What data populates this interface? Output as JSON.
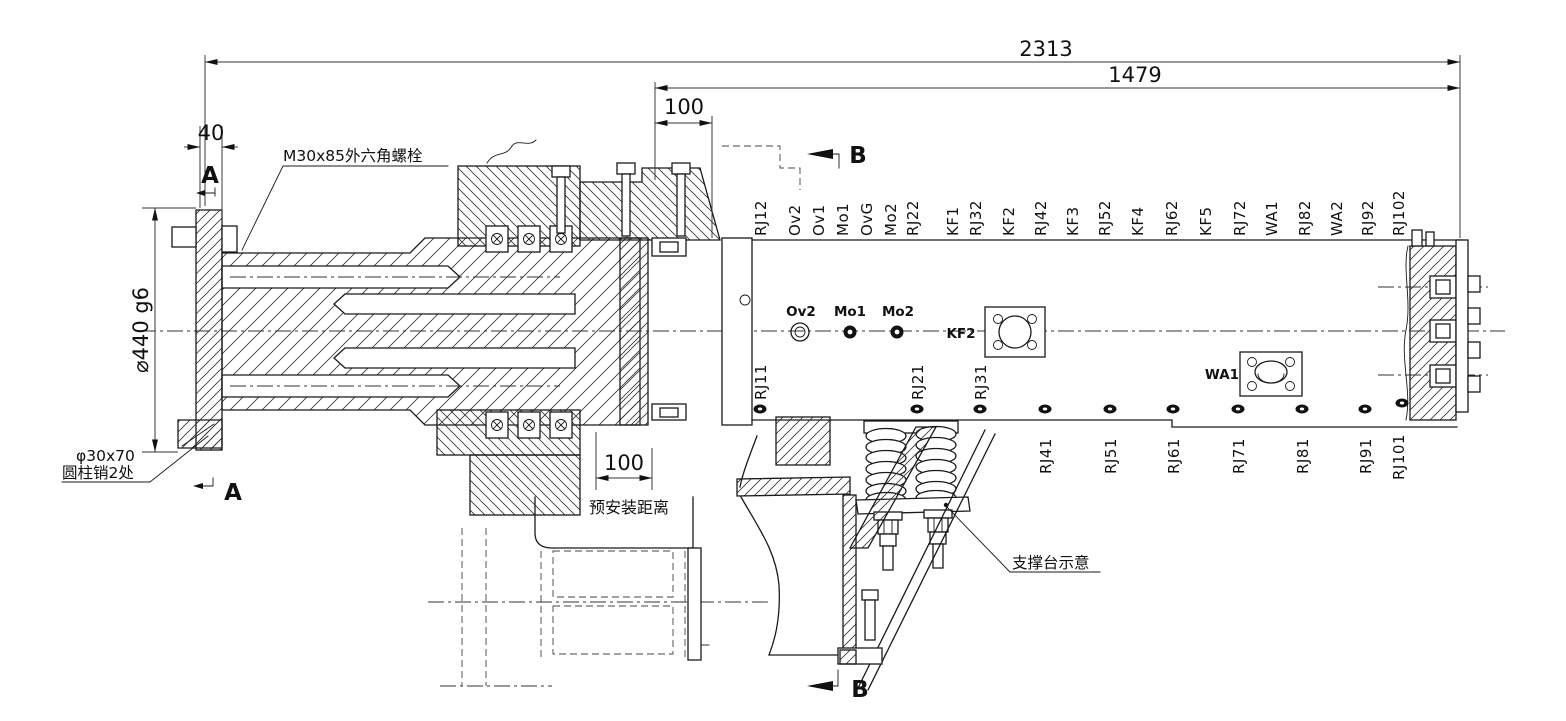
{
  "drawing": {
    "background": "#ffffff",
    "line_color": "#1a1a1a",
    "dimensions": {
      "overall_length": "2313",
      "beam_length": "1479",
      "top_offset": "100",
      "flange_thickness": "40",
      "flange_diameter": "⌀440 g6",
      "preinstall_gap": "100",
      "preinstall_note": "预安装距离"
    },
    "callouts": {
      "hex_bolt": "M30x85外六角螺栓",
      "pin_size": "φ30x70",
      "pin_note": "圆柱销2处",
      "support_note": "支撑台示意"
    },
    "section_markers": {
      "a": "A",
      "b": "B"
    },
    "top_port_labels": [
      "RJ12",
      "Ov2",
      "Ov1",
      "Mo1",
      "OvG",
      "Mo2",
      "RJ22",
      "KF1",
      "RJ32",
      "KF2",
      "RJ42",
      "KF3",
      "RJ52",
      "KF4",
      "RJ62",
      "KF5",
      "RJ72",
      "WA1",
      "RJ82",
      "WA2",
      "RJ92",
      "RJ102"
    ],
    "upper_hole_labels": [
      "RJ11",
      "RJ21",
      "RJ31"
    ],
    "lower_hole_labels": [
      "RJ41",
      "RJ51",
      "RJ61",
      "RJ71",
      "RJ81",
      "RJ91",
      "RJ101"
    ],
    "centerline_point_labels": [
      "Ov2",
      "Mo1",
      "Mo2"
    ],
    "plate_labels": [
      "KF2",
      "WA1"
    ]
  }
}
